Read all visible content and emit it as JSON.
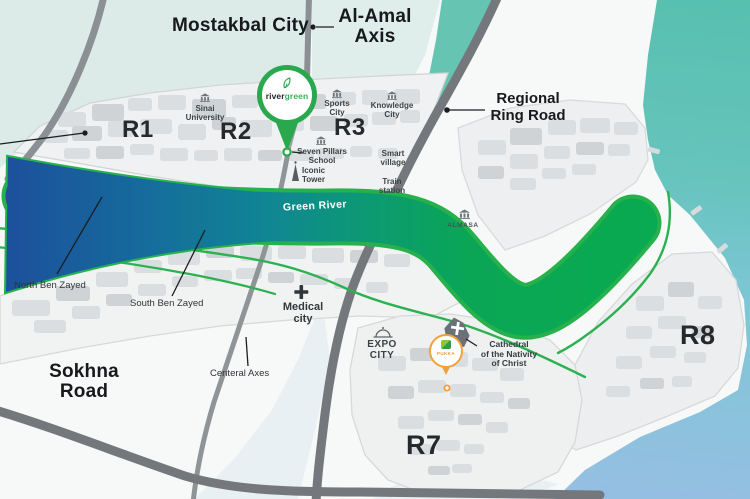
{
  "areas": {
    "mostakbal_city": "Mostakbal City",
    "al_amal_axis": "Al‑Amal\nAxis",
    "regional_ring_road": "Regional\nRing Road",
    "sokhna_road": "Sokhna\nRoad",
    "green_river": "Green River",
    "north_ben_zayed": "North Ben Zayed",
    "south_ben_zayed": "South Ben Zayed",
    "centeral_axes": "Centeral Axes",
    "partial_road_label": "ad"
  },
  "districts": {
    "r1": "R1",
    "r2": "R2",
    "r3": "R3",
    "r7": "R7",
    "r8": "R8"
  },
  "landmarks": {
    "sinai_university": "Sinai\nUniversity",
    "sports_city": "Sports\nCity",
    "knowledge_city": "Knowledge\nCity",
    "seven_pillars_school": "Seven Pillars\nSchool",
    "iconic_tower": "Iconic\nTower",
    "smart_village": "Smart\nvillage",
    "train_station": "Train\nstation",
    "almasa": "ALMASA",
    "medical_city": "Medical\ncity",
    "expo_city": "EXPO\nCITY",
    "cathedral": "Cathedral\nof the Nativity\nof Christ"
  },
  "markers": {
    "rivergreen": {
      "name_part1": "river",
      "name_part2": "green",
      "tagline": "· · · · · · · ·"
    },
    "pukka": {
      "label": "PUKKA"
    }
  },
  "colors": {
    "river_border_green": "#27b14c",
    "river_blue": "#1d4f9c",
    "river_teal": "#108694",
    "river_green": "#09aa50",
    "pin_green": "#2aa84d",
    "pukka_orange": "#f0a13c",
    "road_dark_gray": "#74787c",
    "water_teal": "#58c0af",
    "water_blue": "#95bfe2"
  }
}
